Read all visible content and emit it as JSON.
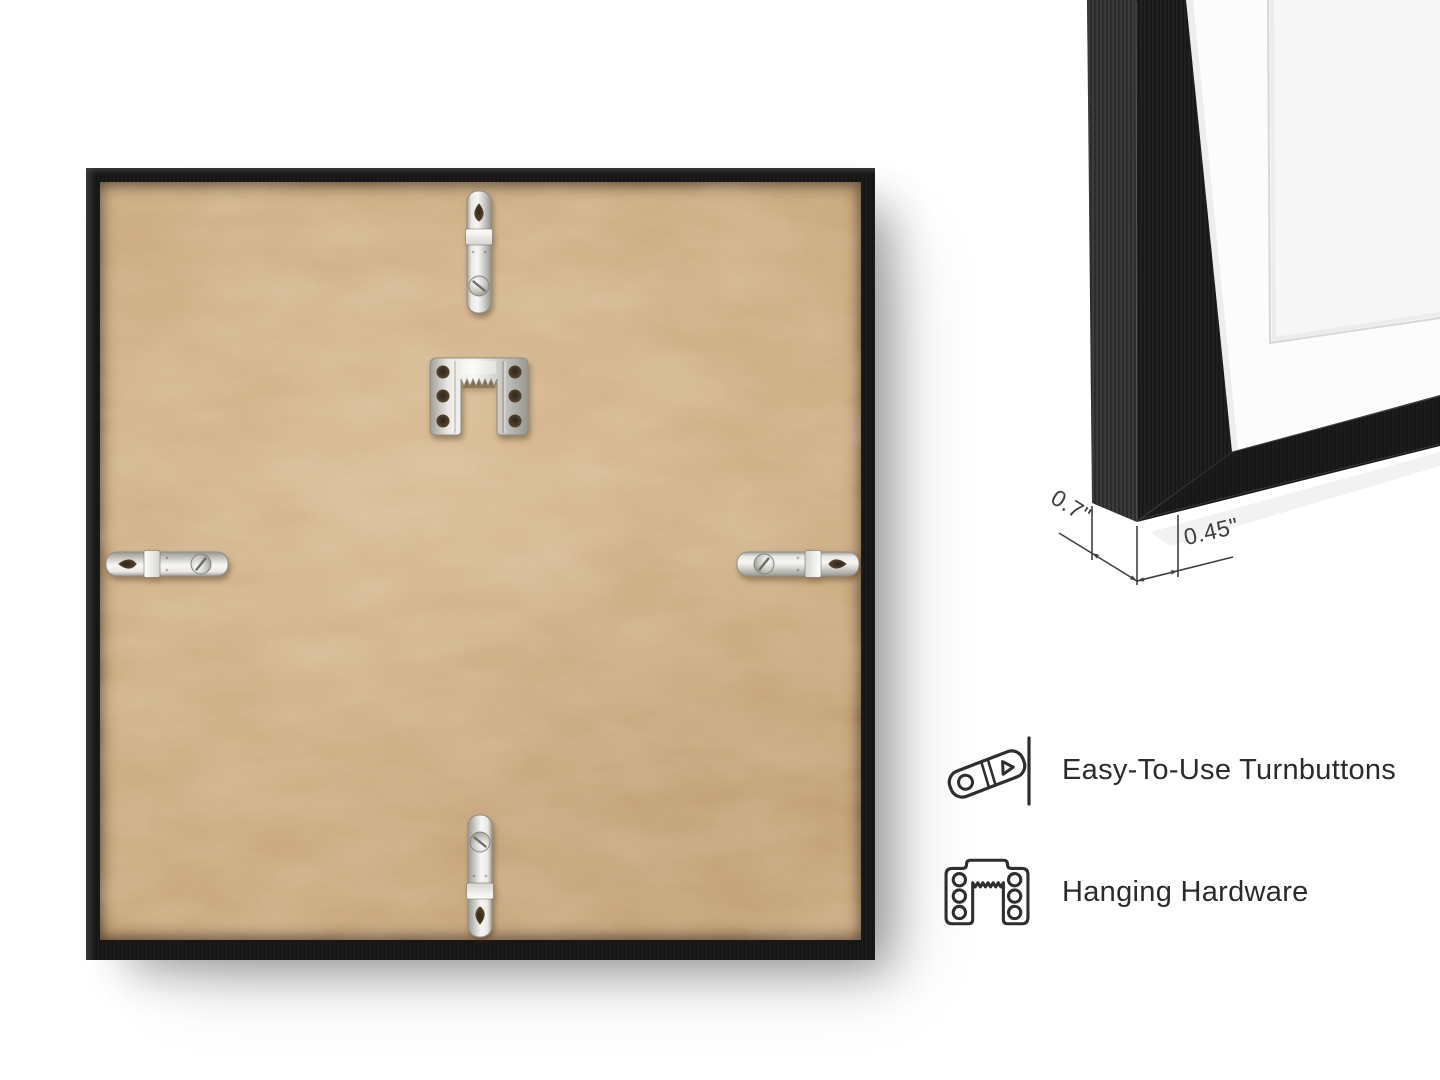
{
  "page": {
    "background_color": "#ffffff"
  },
  "back_view": {
    "description": "back of square black picture frame with kraft MDF backing board",
    "frame_color": "#161616",
    "backing_board_color": "#c9a87d",
    "hardware_metal_color": "#dcdbd7",
    "hardware": [
      "turnbutton-top",
      "sawtooth-hanger-plate",
      "turnbutton-left",
      "turnbutton-right",
      "turnbutton-bottom"
    ]
  },
  "corner_detail": {
    "description": "close-up of frame corner with white mat",
    "frame_color": "#1a1a1a",
    "mat_color": "#fcfcfc",
    "artwork_color": "#f6f6f7",
    "dimensions": {
      "depth": "0.7\"",
      "moulding_width": "0.45\""
    }
  },
  "features": [
    {
      "icon": "turnbutton-icon",
      "label": "Easy-To-Use Turnbuttons"
    },
    {
      "icon": "hanging-hardware-icon",
      "label": "Hanging Hardware"
    }
  ],
  "text_color": "#2b2b2b"
}
